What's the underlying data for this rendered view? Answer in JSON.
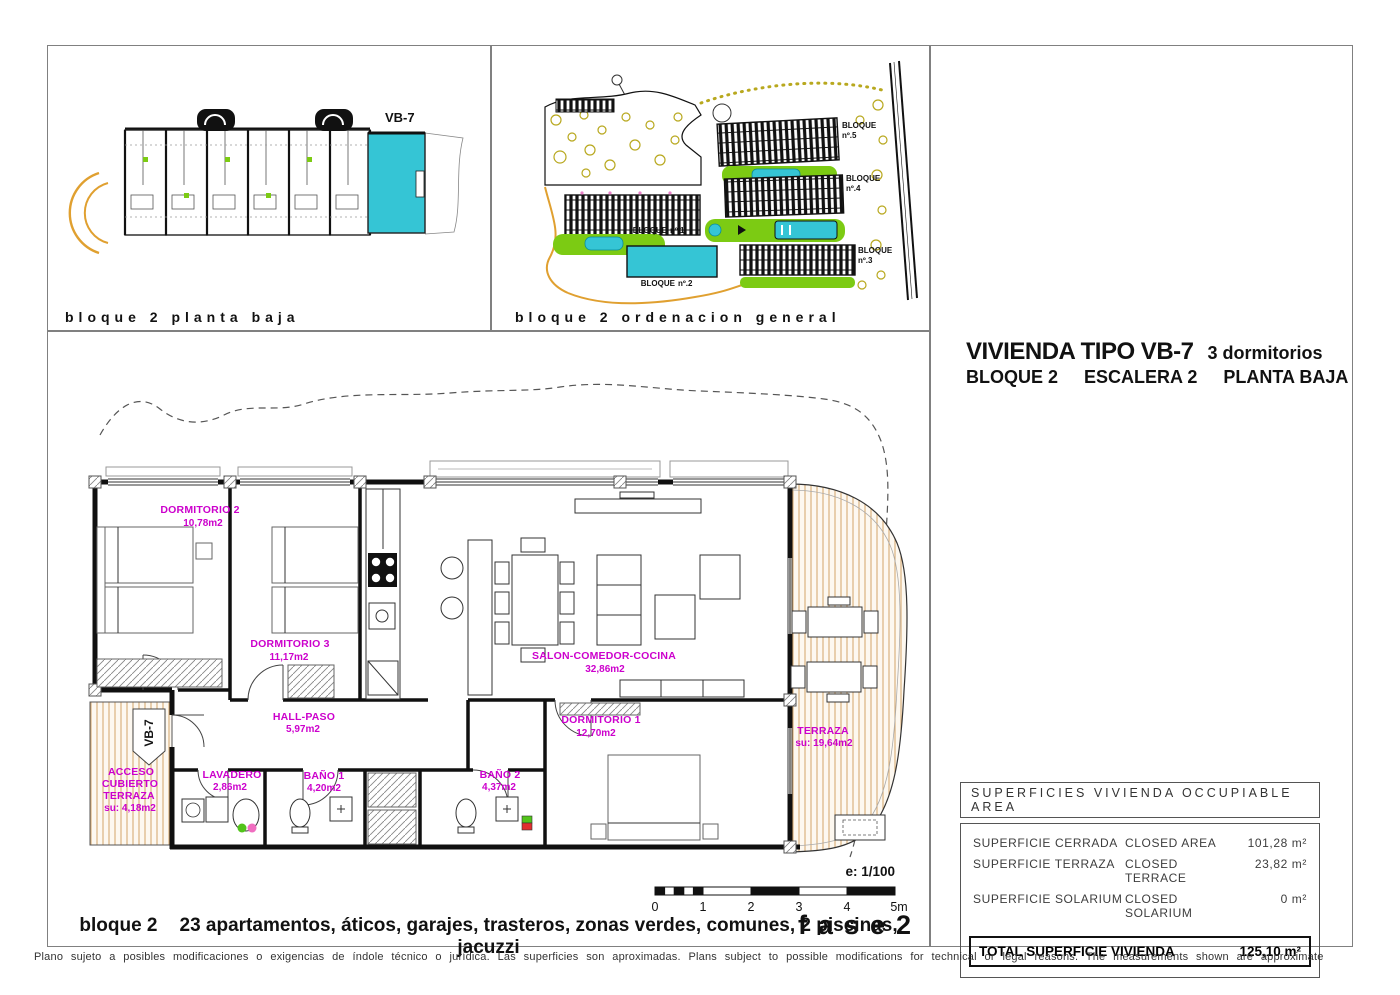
{
  "panels": {
    "planta_baja": {
      "caption": "bloque 2 planta baja",
      "unit_label": "VB-7"
    },
    "ordenacion": {
      "caption": "bloque 2 ordenacion general",
      "bloques": [
        {
          "word": "BLOQUE",
          "num": "nº.1"
        },
        {
          "word": "BLOQUE",
          "num": "nº.2"
        },
        {
          "word": "BLOQUE",
          "num": "nº.3"
        },
        {
          "word": "BLOQUE",
          "num": "nº.4"
        },
        {
          "word": "BLOQUE",
          "num": "nº.5"
        }
      ]
    }
  },
  "title": {
    "line1_main": "VIVIENDA TIPO VB-7",
    "line1_sub": "3 dormitorios",
    "line2_parts": [
      "BLOQUE 2",
      "ESCALERA 2",
      "PLANTA BAJA"
    ]
  },
  "rooms": {
    "dormitorio2": {
      "name": "DORMITORIO 2",
      "area": "10,78m2"
    },
    "dormitorio3": {
      "name": "DORMITORIO 3",
      "area": "11,17m2"
    },
    "salon": {
      "name": "SALON-COMEDOR-COCINA",
      "area": "32,86m2"
    },
    "hall": {
      "name": "HALL-PASO",
      "area": "5,97m2"
    },
    "dormitorio1": {
      "name": "DORMITORIO 1",
      "area": "12,70m2"
    },
    "lavadero": {
      "name": "LAVADERO",
      "area": "2,86m2"
    },
    "bano1": {
      "name": "BAÑO 1",
      "area": "4,20m2"
    },
    "bano2": {
      "name": "BAÑO 2",
      "area": "4,37m2"
    },
    "terraza": {
      "name": "TERRAZA",
      "area": "su: 19,64m2"
    },
    "acceso": {
      "l1": "ACCESO",
      "l2": "CUBIERTO",
      "l3": "TERRAZA",
      "area": "su: 4,18m2"
    }
  },
  "entry_label": "VB-7",
  "scale": {
    "label": "e: 1/100",
    "ticks": [
      "0",
      "1",
      "2",
      "3",
      "4",
      "5m"
    ],
    "phase": "fase2"
  },
  "bottom_caption": {
    "part1": "bloque 2",
    "part2": "23 apartamentos, áticos, garajes, trasteros, zonas verdes, comunes, 2 piscinas, jacuzzi"
  },
  "surfaces": {
    "header": "SUPERFICIES VIVIENDA OCCUPIABLE AREA",
    "rows": [
      {
        "es": "SUPERFICIE CERRADA",
        "en": "CLOSED AREA",
        "value": "101,28 m²"
      },
      {
        "es": "SUPERFICIE TERRAZA",
        "en": "CLOSED TERRACE",
        "value": "23,82 m²"
      },
      {
        "es": "SUPERFICIE SOLARIUM",
        "en": "CLOSED SOLARIUM",
        "value": "0 m²"
      }
    ],
    "total_label": "TOTAL SUPERFICIE VIVIENDA",
    "total_value": "125,10 m²"
  },
  "disclaimer": "Plano sujeto a posibles modificaciones o exigencias de índole técnico o jurídica. Las superficies son aproximadas. Plans subject to possible modifications for technical or legal reasons. The measurements shown are approximate",
  "colors": {
    "highlight_cyan": "#35c5d5",
    "label_magenta": "#cc00cc",
    "deck_tan": "#d8ab74",
    "green": "#7ccb13",
    "olive": "#b8a81e",
    "road_orange": "#e0a030"
  }
}
